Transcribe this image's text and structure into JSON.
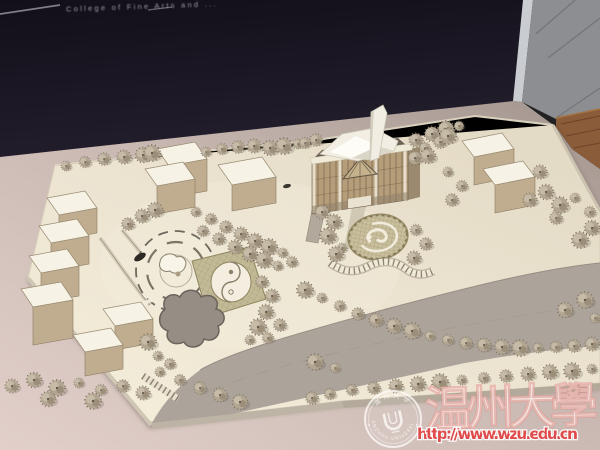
{
  "photo": {
    "sign_text": "College of Fine Arts and ...",
    "watermark": {
      "title_zh": "温州大學",
      "url": "http://www.wzu.edu.cn",
      "seal_top_zh": "温州大学",
      "seal_bottom_en": "WENZHOU UNIVERSITY",
      "seal_center_glyph": "U"
    },
    "colors": {
      "background_dark": "#1a1622",
      "window_panel_gray": "#8d8e92",
      "table_surface_mauve": "#c9b8b2",
      "wood_edge_brown": "#8a5c3a",
      "model_base_cream": "#ece4d1",
      "building_top_white": "#f6f2e5",
      "building_front_tan": "#c0ad90",
      "road_gray": "#aca49b",
      "tree_khaki": "#b2a692",
      "watermark_red": "#e24343",
      "watermark_white": "#faeee8"
    }
  }
}
